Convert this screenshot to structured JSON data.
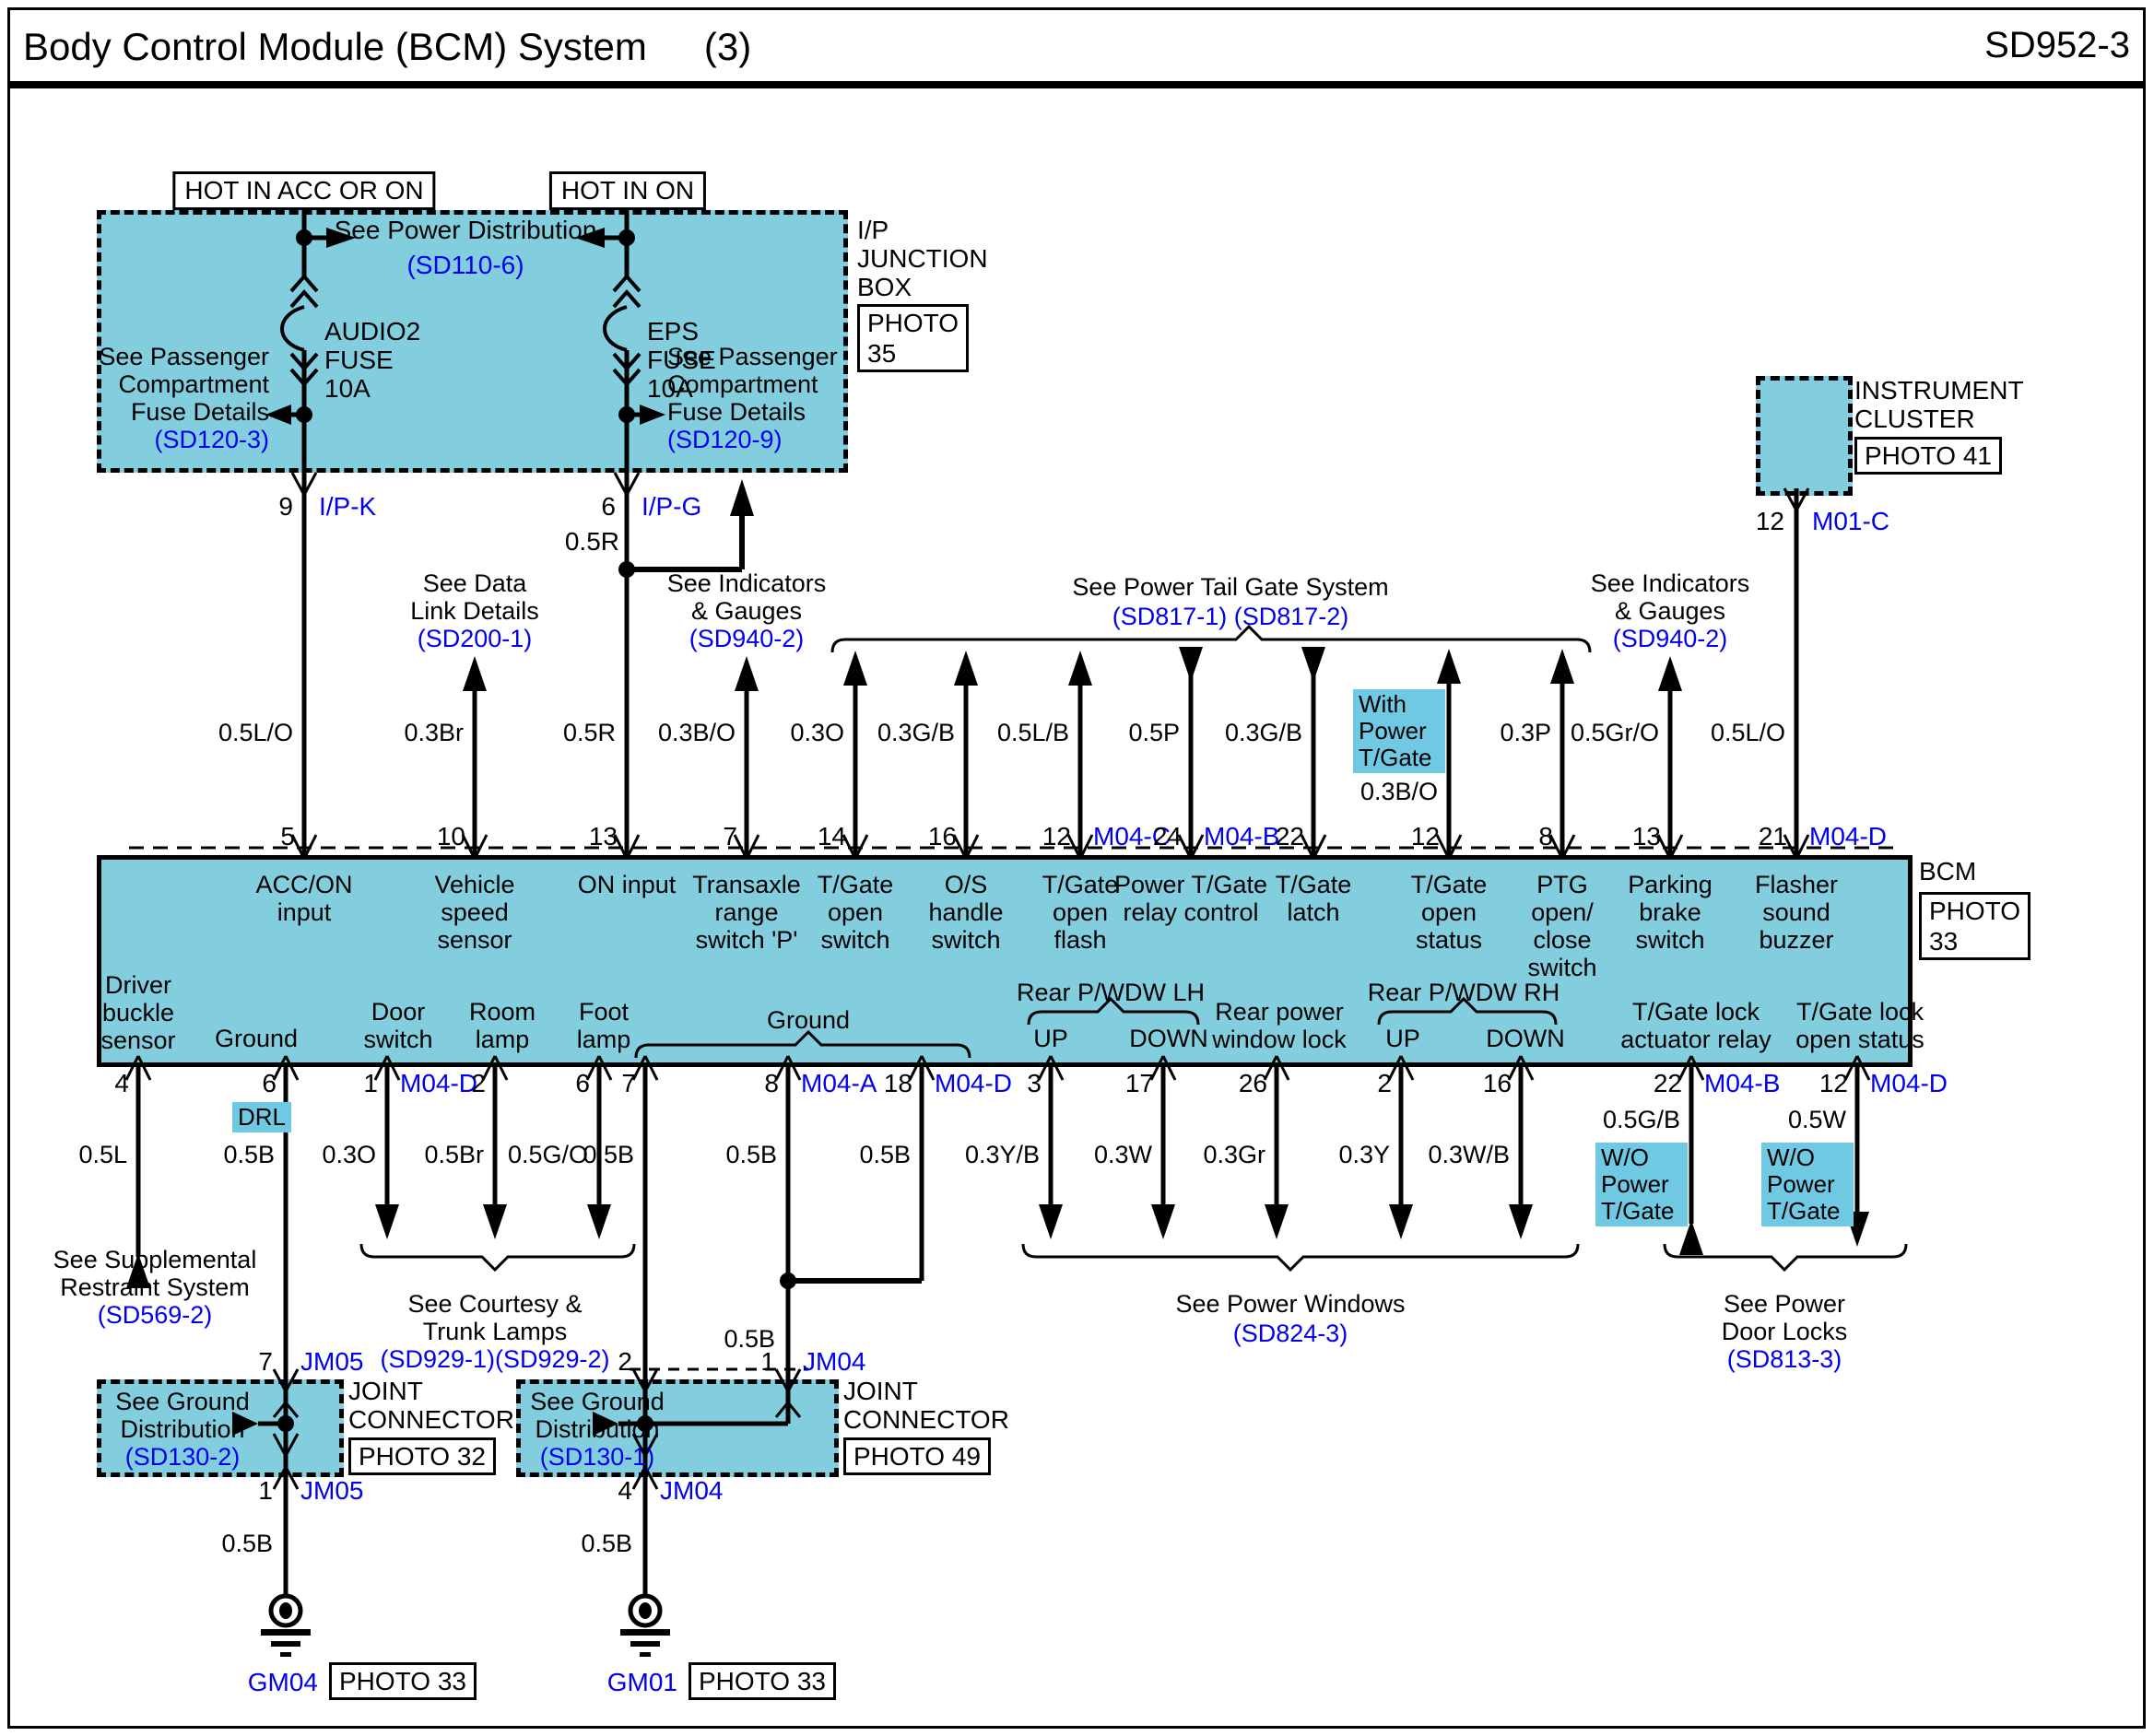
{
  "header": {
    "title": "Body Control Module (BCM) System",
    "index": "(3)",
    "code": "SD952-3"
  },
  "power_rails": [
    {
      "label": "HOT IN ACC OR ON"
    },
    {
      "label": "HOT IN ON"
    }
  ],
  "ip_junction_box": {
    "name": "I/P\nJUNCTION\nBOX",
    "photo": "PHOTO\n35",
    "power_distribution": {
      "text": "See Power Distribution",
      "ref": "(SD110-6)"
    },
    "fuses": [
      {
        "name": "AUDIO2\nFUSE\n10A"
      },
      {
        "name": "EPS\nFUSE\n10A"
      }
    ],
    "passenger_refs": [
      {
        "text": "See Passenger\nCompartment\nFuse Details",
        "ref": "(SD120-3)"
      },
      {
        "text": "See Passenger\nCompartment\nFuse Details",
        "ref": "(SD120-9)"
      }
    ],
    "out_pins": [
      {
        "pin": "9",
        "conn": "I/P-K"
      },
      {
        "pin": "6",
        "conn": "I/P-G"
      }
    ],
    "branch_wire": "0.5R"
  },
  "instrument_cluster": {
    "name": "INSTRUMENT\nCLUSTER",
    "photo": "PHOTO 41",
    "pin": "12",
    "conn": "M01-C"
  },
  "refs_top": [
    {
      "text": "See Data\nLink Details",
      "ref": "(SD200-1)"
    },
    {
      "text": "See Indicators\n& Gauges",
      "ref": "(SD940-2)"
    },
    {
      "text": "See Power Tail Gate System",
      "ref": "(SD817-1) (SD817-2)"
    },
    {
      "text": "See Indicators\n& Gauges",
      "ref": "(SD940-2)"
    }
  ],
  "bcm": {
    "name": "BCM",
    "photo": "PHOTO\n33",
    "top_pins": [
      {
        "pin": "5",
        "wire": "0.5L/O",
        "label": "ACC/ON\ninput"
      },
      {
        "pin": "10",
        "wire": "0.3Br",
        "label": "Vehicle\nspeed\nsensor"
      },
      {
        "pin": "13",
        "wire": "0.5R",
        "label": "ON input"
      },
      {
        "pin": "7",
        "wire": "0.3B/O",
        "label": "Transaxle\nrange\nswitch 'P'"
      },
      {
        "pin": "14",
        "wire": "0.3O",
        "label": "T/Gate\nopen\nswitch"
      },
      {
        "pin": "16",
        "wire": "0.3G/B",
        "label": "O/S\nhandle\nswitch"
      },
      {
        "pin": "12",
        "conn": "M04-C",
        "wire": "0.5L/B",
        "label": "T/Gate\nopen\nflash"
      },
      {
        "pin": "24",
        "conn": "M04-B",
        "wire": "0.5P",
        "label": "Power T/Gate\nrelay control"
      },
      {
        "pin": "22",
        "wire": "0.3G/B",
        "label": "T/Gate\nlatch"
      },
      {
        "pin": "12",
        "wire": "0.3B/O",
        "label": "T/Gate\nopen\nstatus",
        "note": "With\nPower\nT/Gate"
      },
      {
        "pin": "8",
        "wire": "0.3P",
        "label": "PTG\nopen/\nclose\nswitch"
      },
      {
        "pin": "13",
        "wire": "0.5Gr/O",
        "label": "Parking\nbrake\nswitch"
      },
      {
        "pin": "21",
        "conn": "M04-D",
        "wire": "0.5L/O",
        "label": "Flasher\nsound\nbuzzer"
      }
    ],
    "bottom_pins": [
      {
        "pin": "4",
        "wire": "0.5L",
        "label": "Driver\nbuckle\nsensor"
      },
      {
        "pin": "6",
        "wire": "0.5B",
        "label": "Ground",
        "note": "DRL"
      },
      {
        "pin": "1",
        "conn": "M04-D",
        "wire": "0.3O",
        "label": "Door\nswitch"
      },
      {
        "pin": "2",
        "wire": "0.5Br",
        "label": "Room\nlamp"
      },
      {
        "pin": "6",
        "wire": "0.5G/O",
        "label": "Foot\nlamp"
      },
      {
        "pin": "7",
        "wire": "0.5B",
        "label": ""
      },
      {
        "pin": "8",
        "conn": "M04-A",
        "wire": "0.5B",
        "label": ""
      },
      {
        "pin": "18",
        "conn": "M04-D",
        "wire": "0.5B",
        "label": ""
      },
      {
        "pin": "3",
        "wire": "0.3Y/B",
        "label": "UP"
      },
      {
        "pin": "17",
        "wire": "0.3W",
        "label": "DOWN"
      },
      {
        "pin": "26",
        "wire": "0.3Gr",
        "label": "Rear power\nwindow lock"
      },
      {
        "pin": "2",
        "wire": "0.3Y",
        "label": "UP"
      },
      {
        "pin": "16",
        "wire": "0.3W/B",
        "label": "DOWN"
      },
      {
        "pin": "22",
        "conn": "M04-B",
        "wire": "0.5G/B",
        "label": "T/Gate lock\nactuator relay",
        "note": "W/O\nPower\nT/Gate"
      },
      {
        "pin": "12",
        "conn": "M04-D",
        "wire": "0.5W",
        "label": "T/Gate lock\nopen status",
        "note": "W/O\nPower\nT/Gate"
      }
    ],
    "bottom_groups": [
      {
        "label": "Ground"
      },
      {
        "label": "Rear P/WDW LH"
      },
      {
        "label": "Rear P/WDW RH"
      }
    ],
    "junction_wire": "0.5B"
  },
  "refs_bottom": [
    {
      "text": "See Supplemental\nRestraint System",
      "ref": "(SD569-2)"
    },
    {
      "text": "See Courtesy &\nTrunk Lamps",
      "ref": "(SD929-1)(SD929-2)"
    },
    {
      "text": "See Power Windows",
      "ref": "(SD824-3)"
    },
    {
      "text": "See Power\nDoor Locks",
      "ref": "(SD813-3)"
    }
  ],
  "joint_connectors": [
    {
      "title": "JOINT\nCONNECTOR",
      "photo": "PHOTO 32",
      "ref_text": "See Ground\nDistribution",
      "ref": "(SD130-2)",
      "top_pins": [
        {
          "pin": "7",
          "conn": "JM05"
        }
      ],
      "bottom_pin": {
        "pin": "1",
        "conn": "JM05"
      },
      "wire": "0.5B",
      "ground": {
        "id": "GM04",
        "photo": "PHOTO 33"
      }
    },
    {
      "title": "JOINT\nCONNECTOR",
      "photo": "PHOTO 49",
      "ref_text": "See Ground\nDistribution",
      "ref": "(SD130-1)",
      "top_pins": [
        {
          "pin": "2"
        },
        {
          "pin": "1",
          "conn": "JM04"
        }
      ],
      "bottom_pin": {
        "pin": "4",
        "conn": "JM04"
      },
      "wire": "0.5B",
      "ground": {
        "id": "GM01",
        "photo": "PHOTO 33"
      }
    }
  ]
}
